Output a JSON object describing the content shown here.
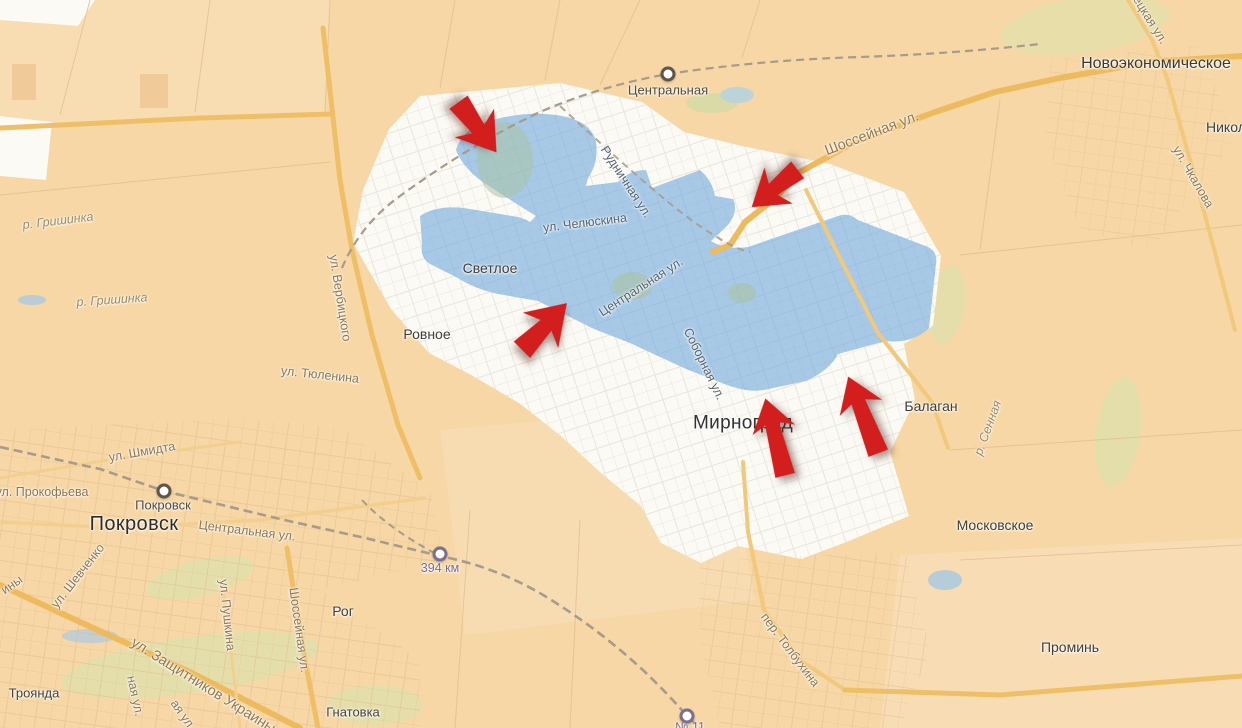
{
  "map": {
    "region": "Pokrovsk–Myrnohrad area road map with highlighted zone and red direction arrows",
    "colors": {
      "fields": "#f6d7a5",
      "city_area": "#fbfaf5",
      "highlight_zone": "#a7c9e6",
      "main_road": "#efbf68",
      "railway": "#a79b8b",
      "arrow": "#d31e1e"
    },
    "arrows": {
      "count": 5,
      "color": "#d31e1e",
      "directions": [
        "southeast",
        "southwest",
        "northeast",
        "north",
        "north-northwest"
      ]
    },
    "labels": [
      {
        "text": "Новоэкономическое",
        "kind": "town"
      },
      {
        "text": "Никол",
        "kind": "town-fragment"
      },
      {
        "text": "Центральная",
        "kind": "station"
      },
      {
        "text": "Шоссейная ул.",
        "kind": "street"
      },
      {
        "text": "ецкая ул.",
        "kind": "street-fragment"
      },
      {
        "text": "ул. Чкалова",
        "kind": "street"
      },
      {
        "text": "Рудничная ул.",
        "kind": "street"
      },
      {
        "text": "ул. Челюскина",
        "kind": "street"
      },
      {
        "text": "Центральная ул.",
        "kind": "street"
      },
      {
        "text": "Соборная ул.",
        "kind": "street"
      },
      {
        "text": "Светлое",
        "kind": "town"
      },
      {
        "text": "Ровное",
        "kind": "town"
      },
      {
        "text": "Мирноград",
        "kind": "city"
      },
      {
        "text": "Балаган",
        "kind": "town"
      },
      {
        "text": "Московское",
        "kind": "town"
      },
      {
        "text": "р. Сенная",
        "kind": "river"
      },
      {
        "text": "р. Гришинка",
        "kind": "river"
      },
      {
        "text": "р. Гришинка",
        "kind": "river"
      },
      {
        "text": "ул. Вербицкого",
        "kind": "street"
      },
      {
        "text": "ул. Тюленина",
        "kind": "street"
      },
      {
        "text": "ул. Шмидта",
        "kind": "street"
      },
      {
        "text": "ул. Прокофьева",
        "kind": "street"
      },
      {
        "text": "Покровск",
        "kind": "station"
      },
      {
        "text": "Покровск",
        "kind": "city"
      },
      {
        "text": "Центральная ул.",
        "kind": "street"
      },
      {
        "text": "ул. Шевченко",
        "kind": "street"
      },
      {
        "text": "ины",
        "kind": "street-fragment"
      },
      {
        "text": "ул. Пушкина",
        "kind": "street"
      },
      {
        "text": "Шоссейная ул.",
        "kind": "street"
      },
      {
        "text": "ная ул.",
        "kind": "street-fragment"
      },
      {
        "text": "ая ул.",
        "kind": "street-fragment"
      },
      {
        "text": "ул. Защитников Украины",
        "kind": "street"
      },
      {
        "text": "Троянда",
        "kind": "town"
      },
      {
        "text": "Рог",
        "kind": "town"
      },
      {
        "text": "Гнатовка",
        "kind": "town"
      },
      {
        "text": "394 км",
        "kind": "station"
      },
      {
        "text": "№ 11",
        "kind": "station"
      },
      {
        "text": "пер. Толбухина",
        "kind": "street"
      },
      {
        "text": "Проминь",
        "kind": "town"
      }
    ]
  }
}
